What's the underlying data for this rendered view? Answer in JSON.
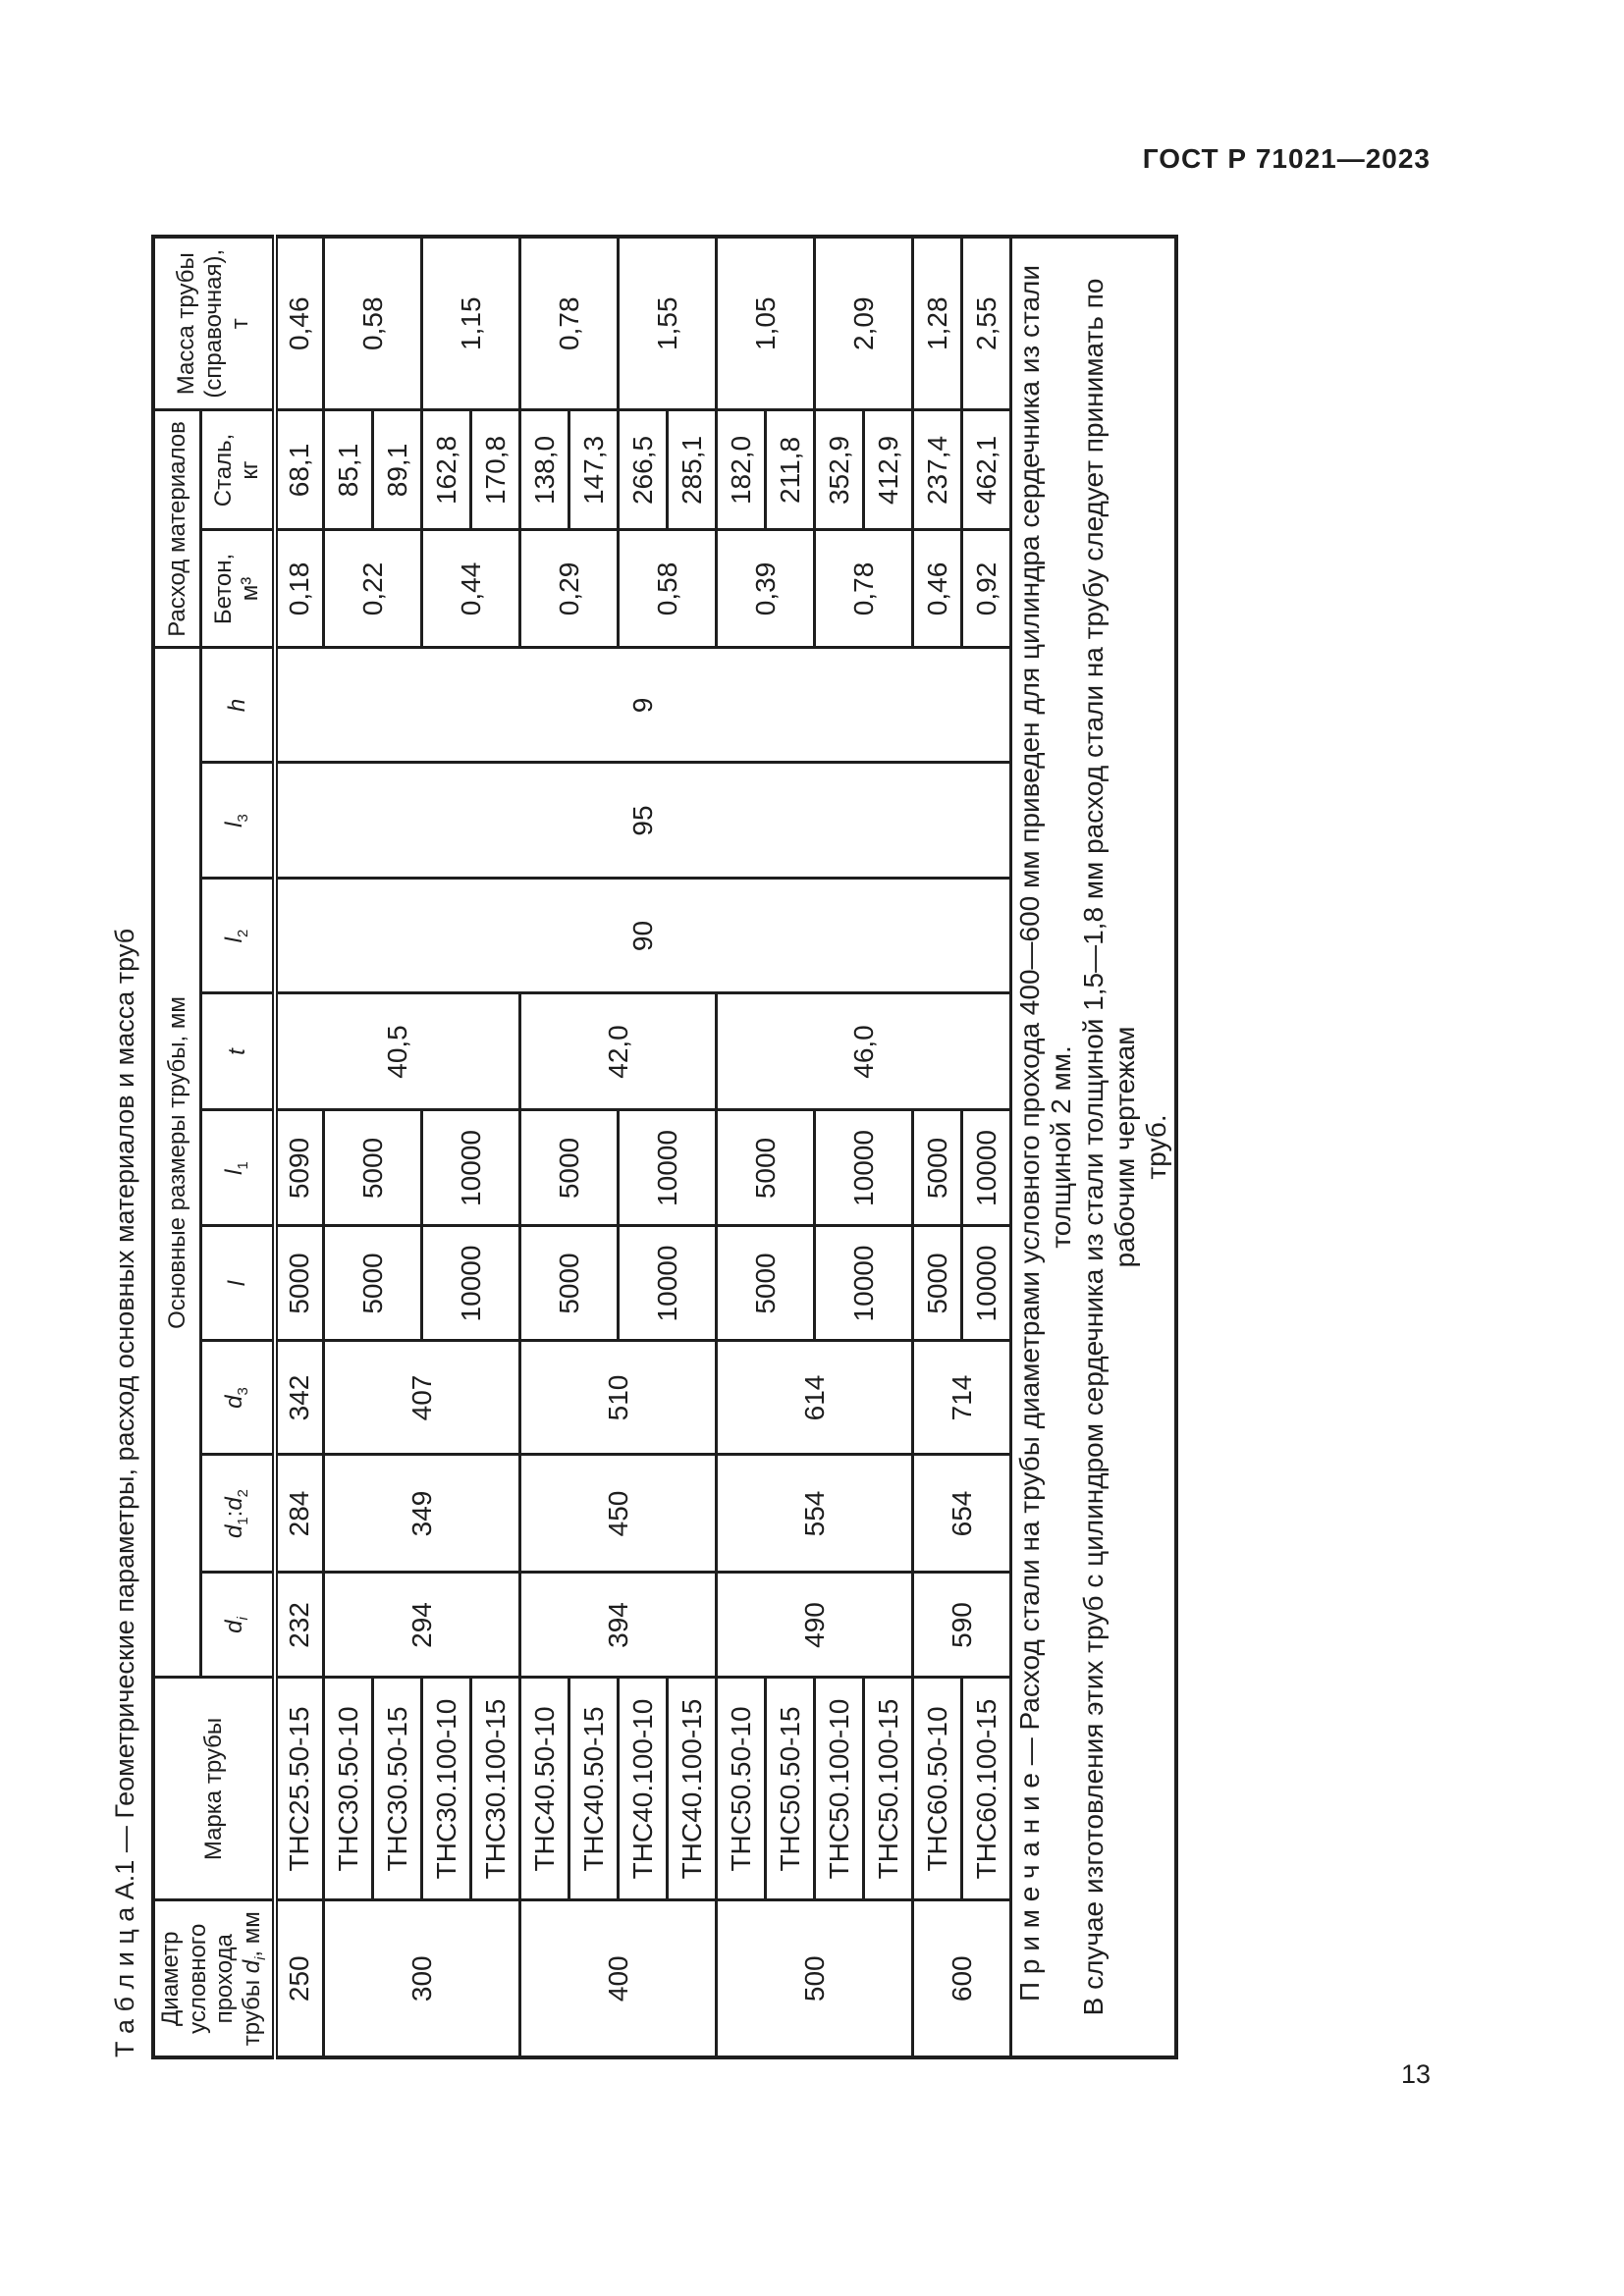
{
  "page": {
    "doc_code": "ГОСТ Р 71021—2023",
    "page_number": "13"
  },
  "table": {
    "title": "Т а б л и ц а   А.1 — Геометрические параметры, расход основных материалов и масса труб",
    "header": {
      "diameter": "Диаметр<br>условного<br>прохода<br>трубы <i>d</i><sub><i>i</i></sub>, мм",
      "marka": "Марка трубы",
      "dims_group": "Основные размеры трубы, мм",
      "consumption_group": "Расход материалов",
      "mass": "Масса трубы<br>(справочная),<br>т",
      "dim_cols": [
        "<i>d</i><sub><i>i</i></sub>",
        "<i>d</i><sub>1</sub>:<i>d</i><sub>2</sub>",
        "<i>d</i><sub>3</sub>",
        "<i>l</i>",
        "<i>l</i><sub>1</sub>",
        "<i>t</i>",
        "<i>l</i><sub>2</sub>",
        "<i>l</i><sub>3</sub>",
        "<i>h</i>"
      ],
      "beton": "Бетон,<br>м³",
      "stal": "Сталь,<br>кг"
    },
    "rows": [
      [
        {
          "t": "250"
        },
        {
          "t": "ТНС25.50-15"
        },
        {
          "t": "232"
        },
        {
          "t": "284"
        },
        {
          "t": "342"
        },
        {
          "t": "5000"
        },
        {
          "t": "5090"
        },
        {
          "t": "40,5",
          "rs": 5
        },
        {
          "t": "90",
          "rs": 15
        },
        {
          "t": "95",
          "rs": 15
        },
        {
          "t": "9",
          "rs": 15
        },
        {
          "t": "0,18"
        },
        {
          "t": "68,1"
        },
        {
          "t": "0,46"
        }
      ],
      [
        {
          "t": "300",
          "rs": 4
        },
        {
          "t": "ТНС30.50-10"
        },
        {
          "t": "294",
          "rs": 4
        },
        {
          "t": "349",
          "rs": 4
        },
        {
          "t": "407",
          "rs": 4
        },
        {
          "t": "5000",
          "rs": 2
        },
        {
          "t": "5000",
          "rs": 2
        },
        {
          "t": "0,22",
          "rs": 2
        },
        {
          "t": "85,1"
        },
        {
          "t": "0,58",
          "rs": 2
        }
      ],
      [
        {
          "t": "ТНС30.50-15"
        },
        {
          "t": "89,1"
        }
      ],
      [
        {
          "t": "ТНС30.100-10"
        },
        {
          "t": "10000",
          "rs": 2
        },
        {
          "t": "10000",
          "rs": 2
        },
        {
          "t": "0,44",
          "rs": 2
        },
        {
          "t": "162,8"
        },
        {
          "t": "1,15",
          "rs": 2
        }
      ],
      [
        {
          "t": "ТНС30.100-15"
        },
        {
          "t": "170,8"
        }
      ],
      [
        {
          "t": "400",
          "rs": 4
        },
        {
          "t": "ТНС40.50-10"
        },
        {
          "t": "394",
          "rs": 4
        },
        {
          "t": "450",
          "rs": 4
        },
        {
          "t": "510",
          "rs": 4
        },
        {
          "t": "5000",
          "rs": 2
        },
        {
          "t": "5000",
          "rs": 2
        },
        {
          "t": "42,0",
          "rs": 4
        },
        {
          "t": "0,29",
          "rs": 2
        },
        {
          "t": "138,0"
        },
        {
          "t": "0,78",
          "rs": 2
        }
      ],
      [
        {
          "t": "ТНС40.50-15"
        },
        {
          "t": "147,3"
        }
      ],
      [
        {
          "t": "ТНС40.100-10"
        },
        {
          "t": "10000",
          "rs": 2
        },
        {
          "t": "10000",
          "rs": 2
        },
        {
          "t": "0,58",
          "rs": 2
        },
        {
          "t": "266,5"
        },
        {
          "t": "1,55",
          "rs": 2
        }
      ],
      [
        {
          "t": "ТНС40.100-15"
        },
        {
          "t": "285,1"
        }
      ],
      [
        {
          "t": "500",
          "rs": 4
        },
        {
          "t": "ТНС50.50-10"
        },
        {
          "t": "490",
          "rs": 4
        },
        {
          "t": "554",
          "rs": 4
        },
        {
          "t": "614",
          "rs": 4
        },
        {
          "t": "5000",
          "rs": 2
        },
        {
          "t": "5000",
          "rs": 2
        },
        {
          "t": "46,0",
          "rs": 6
        },
        {
          "t": "0,39",
          "rs": 2
        },
        {
          "t": "182,0"
        },
        {
          "t": "1,05",
          "rs": 2
        }
      ],
      [
        {
          "t": "ТНС50.50-15"
        },
        {
          "t": "211,8"
        }
      ],
      [
        {
          "t": "ТНС50.100-10"
        },
        {
          "t": "10000",
          "rs": 2
        },
        {
          "t": "10000",
          "rs": 2
        },
        {
          "t": "0,78",
          "rs": 2
        },
        {
          "t": "352,9"
        },
        {
          "t": "2,09",
          "rs": 2
        }
      ],
      [
        {
          "t": "ТНС50.100-15"
        },
        {
          "t": "412,9"
        }
      ],
      [
        {
          "t": "600",
          "rs": 2
        },
        {
          "t": "ТНС60.50-10"
        },
        {
          "t": "590",
          "rs": 2
        },
        {
          "t": "654",
          "rs": 2
        },
        {
          "t": "714",
          "rs": 2
        },
        {
          "t": "5000"
        },
        {
          "t": "5000"
        },
        {
          "t": "0,46"
        },
        {
          "t": "237,4"
        },
        {
          "t": "1,28"
        }
      ],
      [
        {
          "t": "ТНС60.100-15"
        },
        {
          "t": "10000"
        },
        {
          "t": "10000"
        },
        {
          "t": "0,92"
        },
        {
          "t": "462,1"
        },
        {
          "t": "2,55"
        }
      ]
    ],
    "note": "П р и м е ч а н и е  — Расход стали на трубы диаметрами условного прохода 400—600 мм приведен для цилиндра сердечника из стали толщиной 2 мм.<br>В случае изготовления этих труб с цилиндром сердечника из стали толщиной 1,5—1,8 мм расход стали на трубу следует принимать по рабочим чертежам<br>труб."
  }
}
